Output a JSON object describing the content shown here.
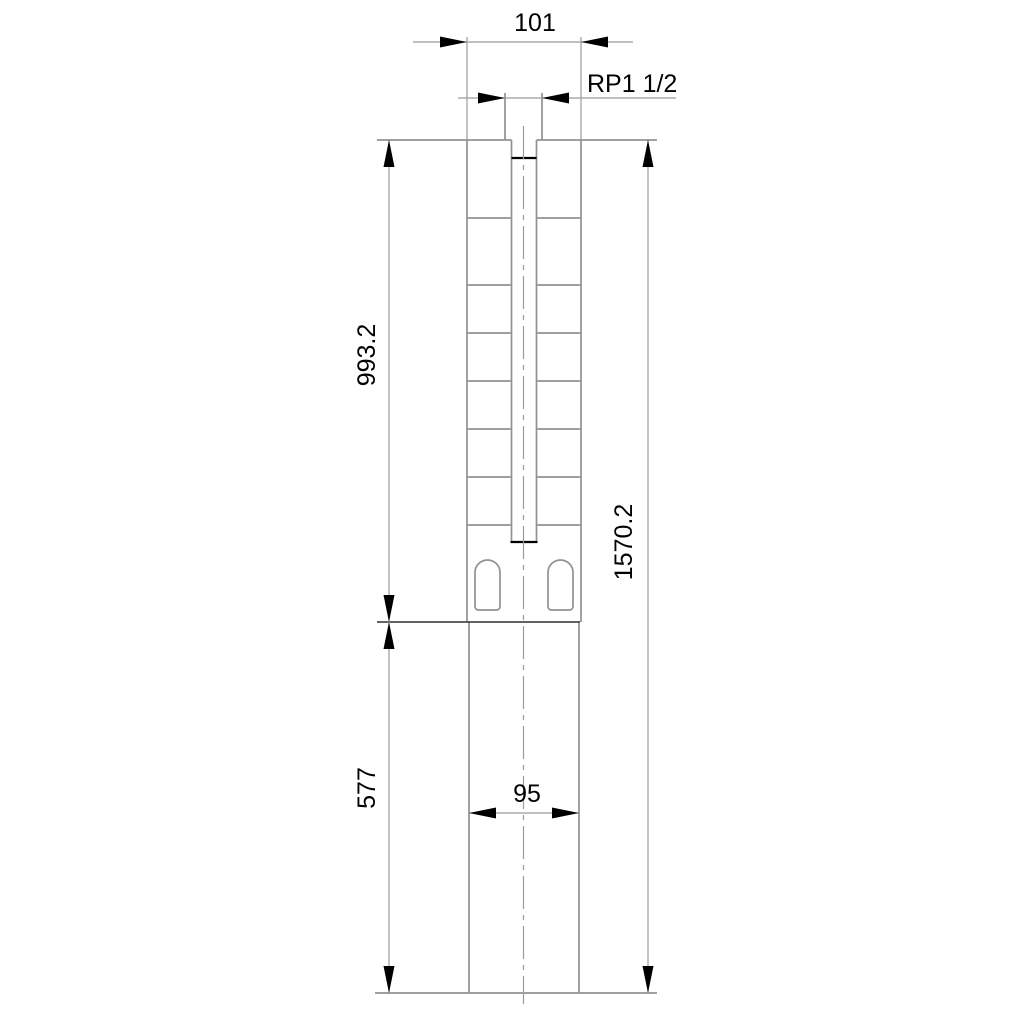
{
  "dimension_labels": {
    "top_width": "101",
    "thread_connection": "RP1 1/2",
    "upper_section_length": "993.2",
    "lower_section_length": "577",
    "total_length": "1570.2",
    "lower_width": "95"
  },
  "colors": {
    "background": "#ffffff",
    "outline": "#929292",
    "dimension": "#9b9b9b",
    "centerline": "#9b9b9b",
    "divider": "#2f2f2f",
    "ink": "#000000"
  }
}
